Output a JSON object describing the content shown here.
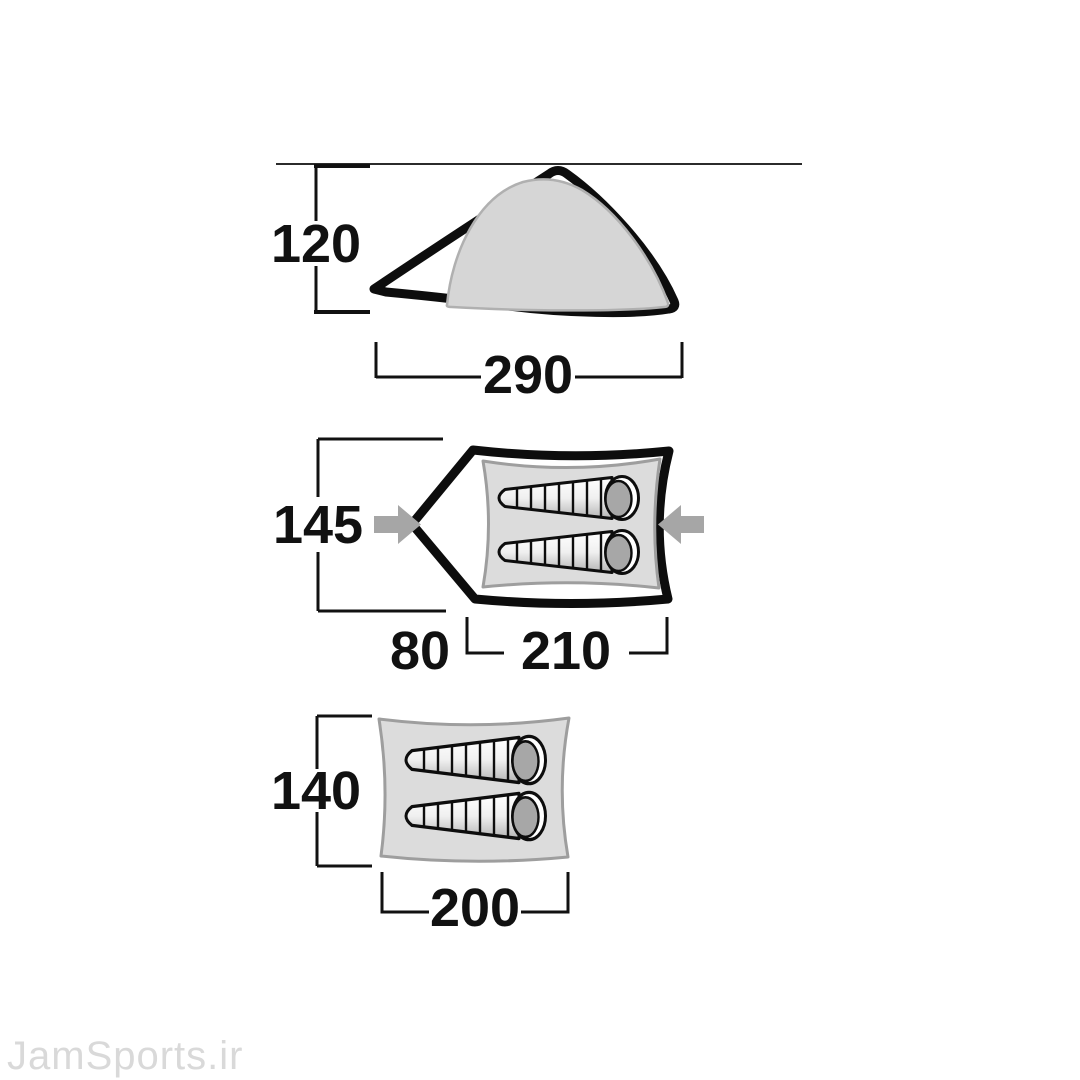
{
  "watermark": {
    "text": "JamSports.ir"
  },
  "side_view": {
    "description": "tent side elevation",
    "height_label": "120",
    "width_label": "290"
  },
  "top_view": {
    "description": "tent top view with vestibule, two sleeping bags, entrance arrows",
    "width_label": "145",
    "vestibule_label": "80",
    "inner_length_label": "210"
  },
  "floor_plan": {
    "description": "inner cabin floor with two sleeping bags",
    "width_label": "140",
    "length_label": "200"
  },
  "colors": {
    "outline_black": "#0d0d0d",
    "dimension_black": "#111111",
    "dome_canvas_gray": "#d6d6d6",
    "floor_gray": "#dcdcdc",
    "floor_border_gray": "#9e9e9e",
    "arrow_gray": "#a6a6a6",
    "hood_gray": "#a7a7a7",
    "watermark_gray": "#d9d9d9"
  }
}
